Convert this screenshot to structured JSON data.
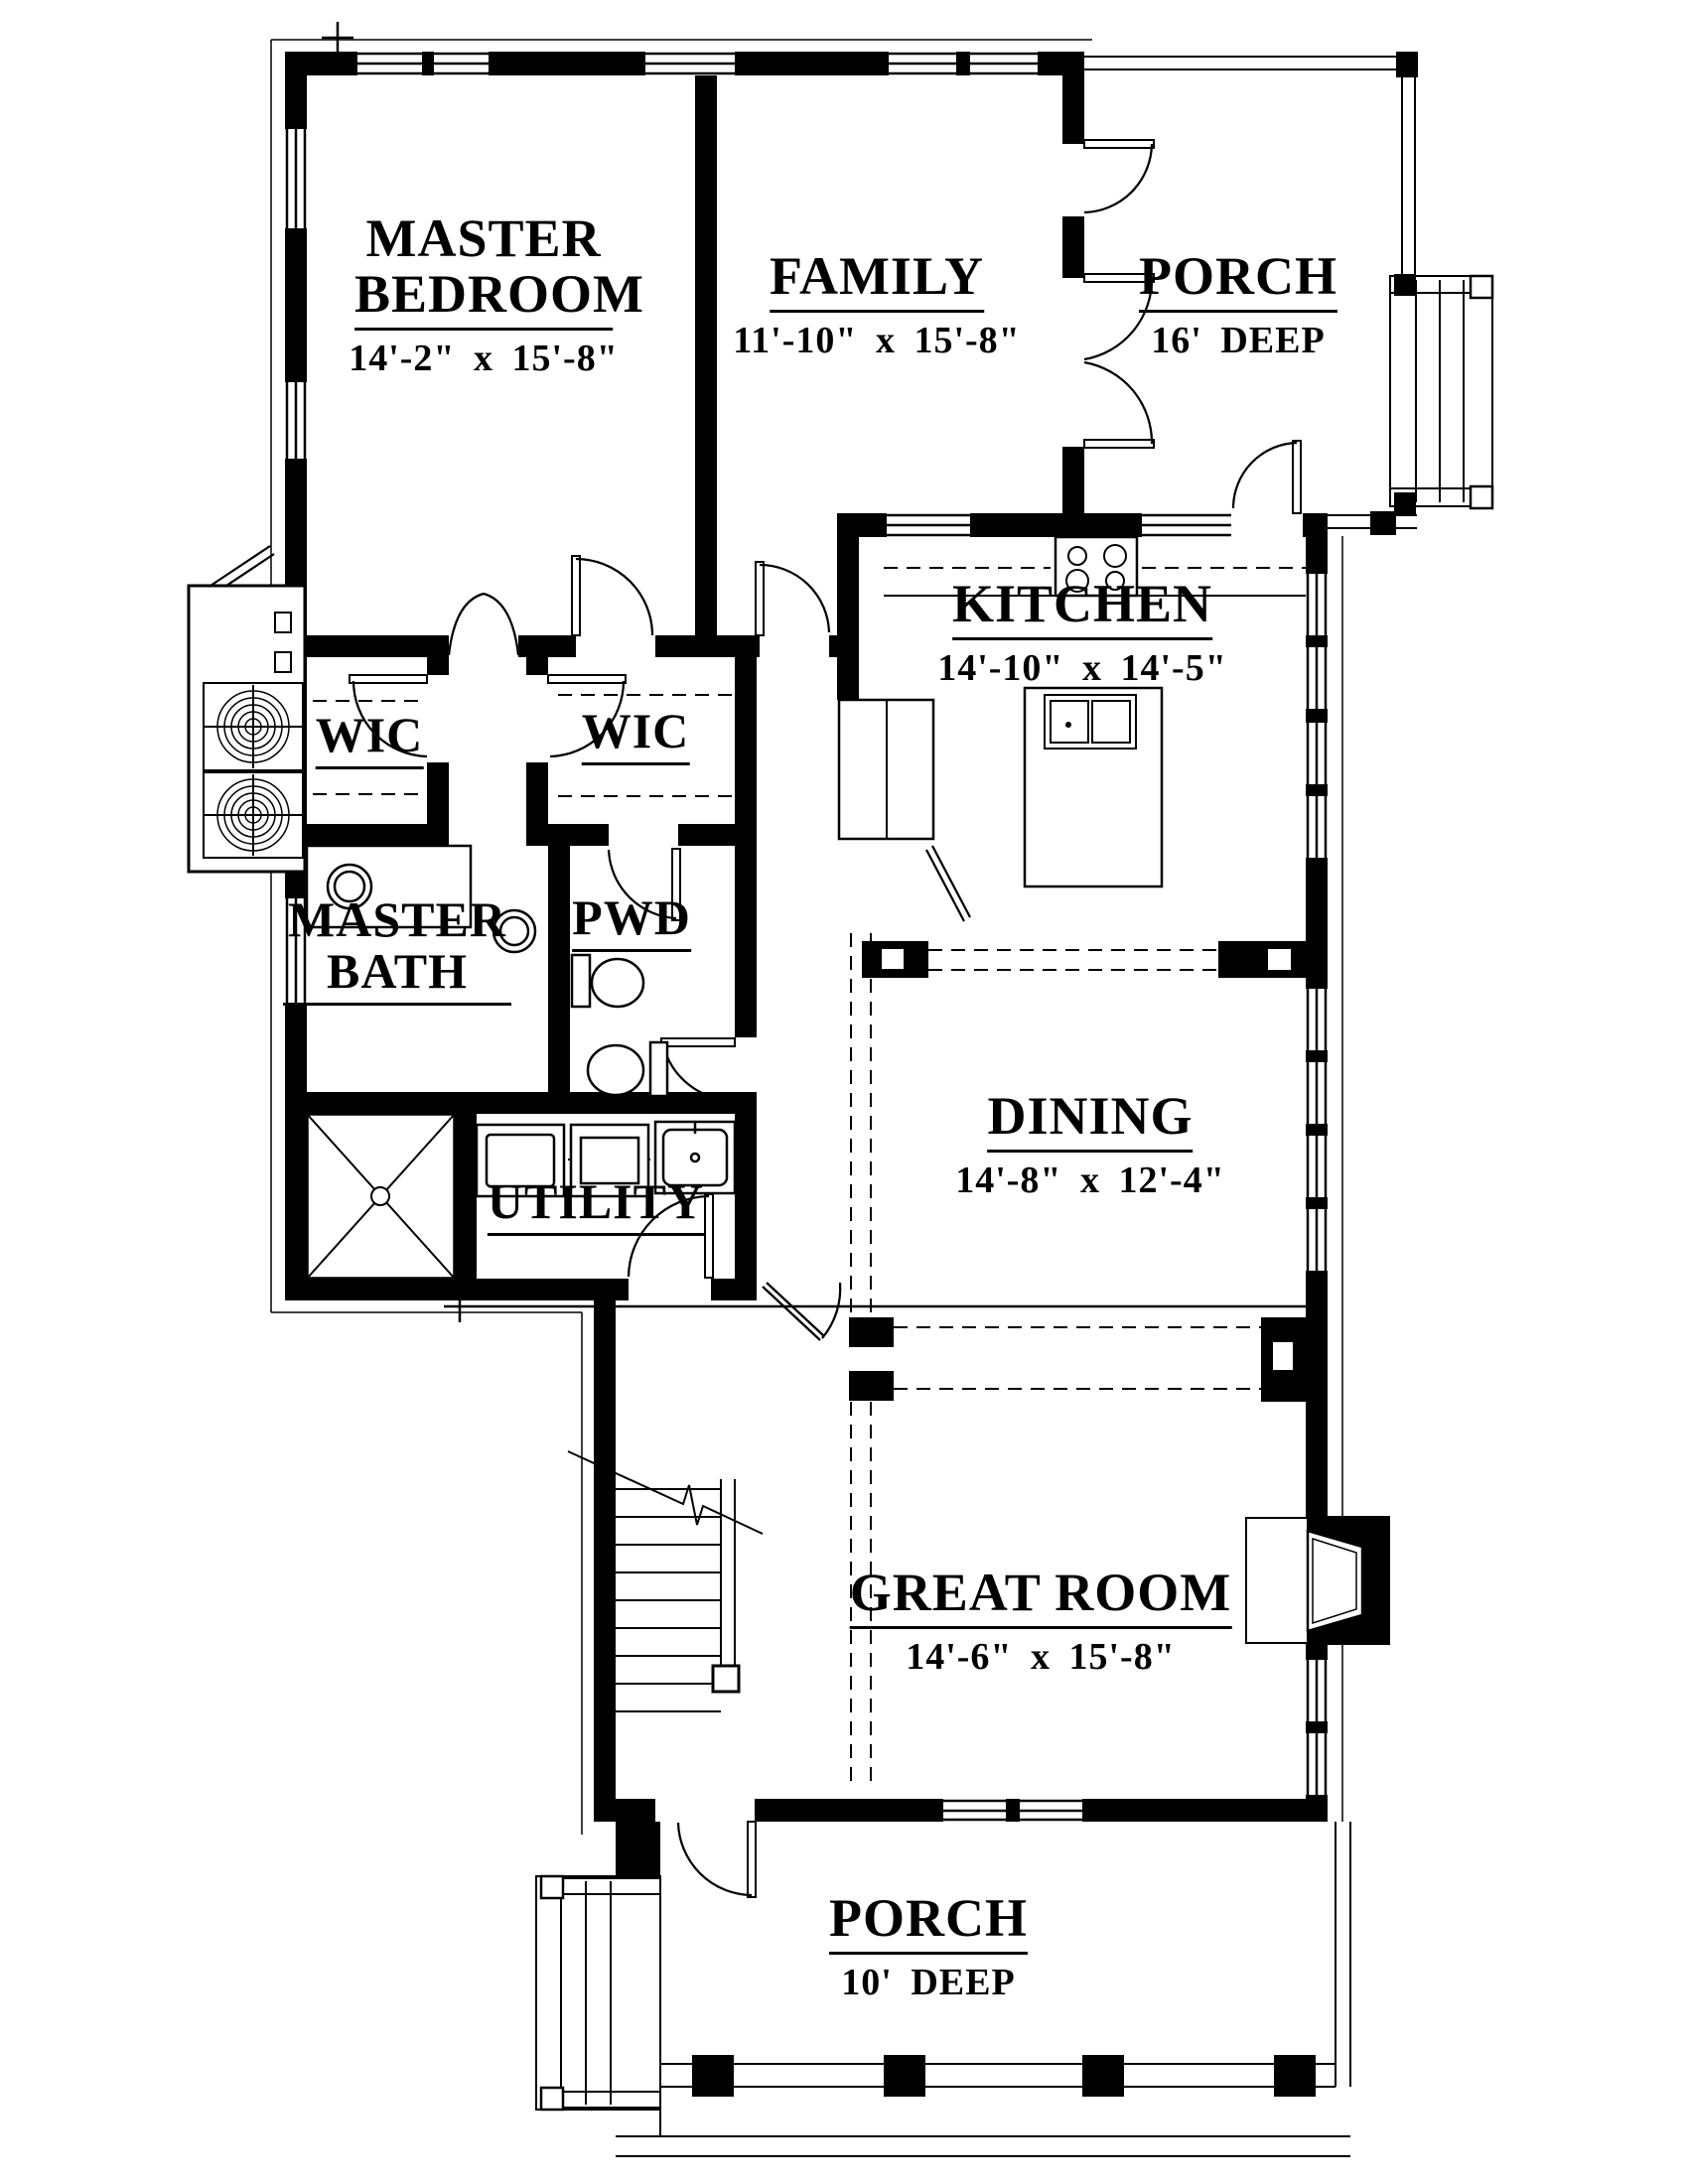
{
  "drawing": {
    "type": "floor-plan",
    "style": "black-line architectural plan"
  },
  "colors": {
    "ink": "#000000",
    "paper": "#ffffff"
  },
  "rooms": [
    {
      "id": "master-bedroom",
      "name": "MASTER BEDROOM",
      "dims": "14'-2\" x 15'-8\""
    },
    {
      "id": "family",
      "name": "FAMILY",
      "dims": "11'-10\" x 15'-8\""
    },
    {
      "id": "porch-upper",
      "name": "PORCH",
      "dims": "16' DEEP"
    },
    {
      "id": "kitchen",
      "name": "KITCHEN",
      "dims": "14'-10\" x 14'-5\""
    },
    {
      "id": "wic-left",
      "name": "WIC",
      "dims": ""
    },
    {
      "id": "wic-right",
      "name": "WIC",
      "dims": ""
    },
    {
      "id": "master-bath",
      "name": "MASTER BATH",
      "dims": ""
    },
    {
      "id": "pwd",
      "name": "PWD",
      "dims": ""
    },
    {
      "id": "utility",
      "name": "UTILITY",
      "dims": ""
    },
    {
      "id": "dining",
      "name": "DINING",
      "dims": "14'-8\" x 12'-4\""
    },
    {
      "id": "great-room",
      "name": "GREAT ROOM",
      "dims": "14'-6\" x 15'-8\""
    },
    {
      "id": "porch-lower",
      "name": "PORCH",
      "dims": "10' DEEP"
    }
  ]
}
